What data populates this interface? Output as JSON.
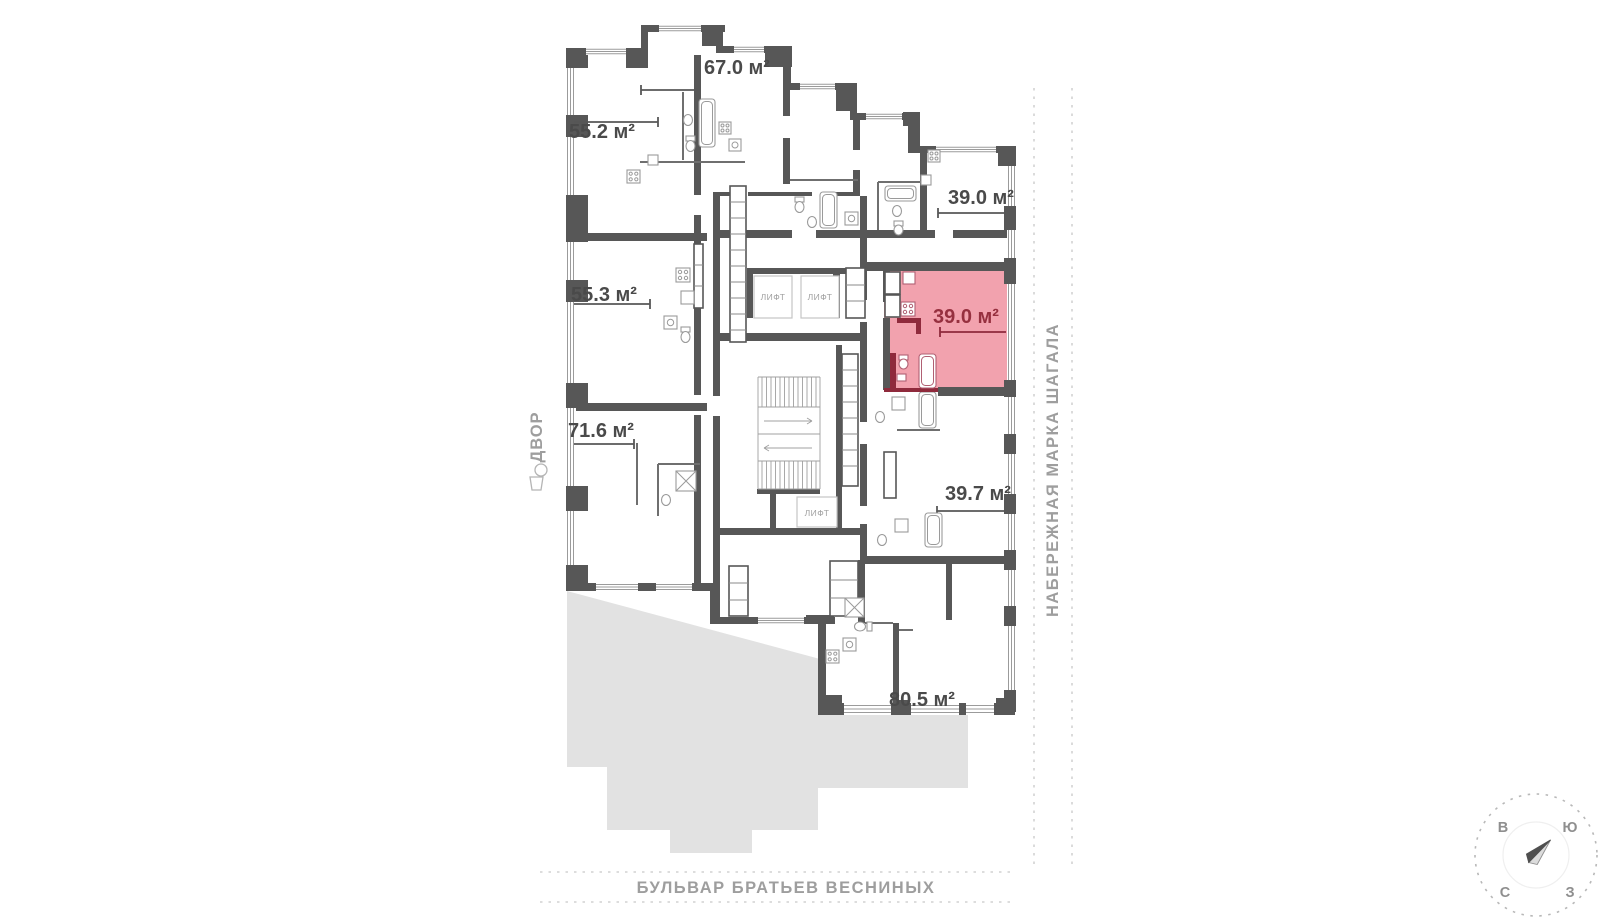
{
  "floor_plan": {
    "units": [
      {
        "id": "67-0",
        "area": "67.0 м²",
        "highlighted": false
      },
      {
        "id": "55-2",
        "area": "55.2 м²",
        "highlighted": false
      },
      {
        "id": "39-0-top",
        "area": "39.0 м²",
        "highlighted": false
      },
      {
        "id": "55-3",
        "area": "55.3 м²",
        "highlighted": false
      },
      {
        "id": "39-0-selected",
        "area": "39.0 м²",
        "highlighted": true
      },
      {
        "id": "71-6",
        "area": "71.6 м²",
        "highlighted": false
      },
      {
        "id": "39-7",
        "area": "39.7 м²",
        "highlighted": false
      },
      {
        "id": "80-5",
        "area": "80.5 м²",
        "highlighted": false
      }
    ],
    "elevators": [
      {
        "label": "ЛИФТ"
      },
      {
        "label": "ЛИФТ"
      },
      {
        "label": "ЛИФТ"
      }
    ],
    "courtyard_label": "ДВОР",
    "streets": {
      "right_vertical": "НАБЕРЕЖНАЯ МАРКА ШАГАЛА",
      "bottom": "БУЛЬВАР БРАТЬЕВ ВЕСНИНЫХ"
    },
    "compass": {
      "top_left": "В",
      "top_right": "Ю",
      "bottom_left": "С",
      "bottom_right": "З"
    },
    "colors": {
      "wall": "#575757",
      "highlight_fill": "#f2a2ae",
      "highlight_wall": "#8f2a3c",
      "highlight_text": "#96303f",
      "footprint": "#e2e2e2",
      "street_text": "#9e9e9e"
    }
  }
}
